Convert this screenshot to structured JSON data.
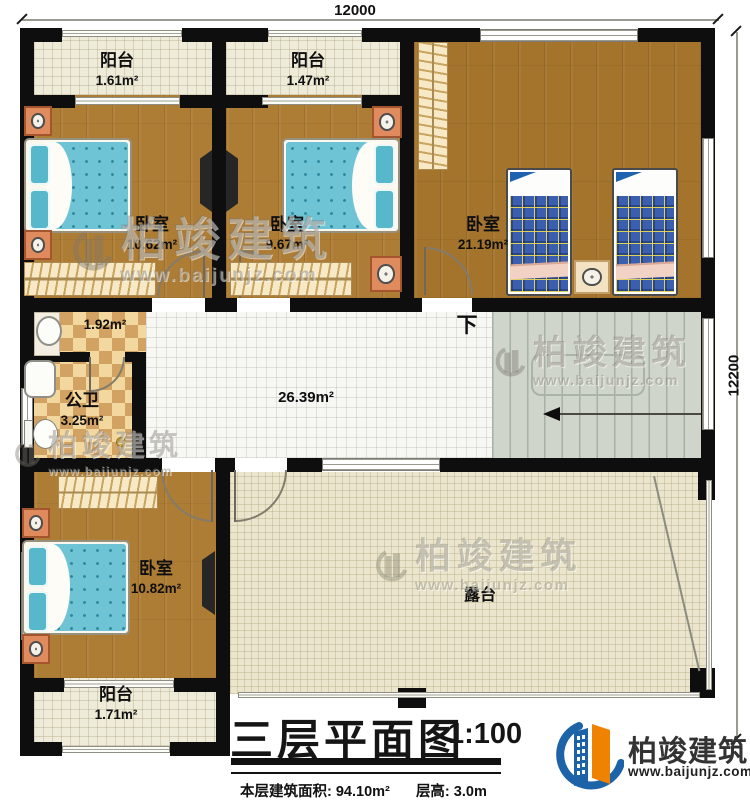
{
  "dimensions": {
    "width_label": "12000",
    "height_label": "12200"
  },
  "rooms": {
    "balcony_top_left": {
      "name": "阳台",
      "area": "1.61m²"
    },
    "balcony_top_mid": {
      "name": "阳台",
      "area": "1.47m²"
    },
    "bedroom_top_left": {
      "name": "卧室",
      "area": "10.62m²"
    },
    "bedroom_top_mid": {
      "name": "卧室",
      "area": "9.67m²"
    },
    "bedroom_top_right": {
      "name": "卧室",
      "area": "21.19m²"
    },
    "washbasin": {
      "area": "1.92m²"
    },
    "bathroom": {
      "name": "公卫",
      "area": "3.25m²"
    },
    "hallway": {
      "area": "26.39m²"
    },
    "bedroom_bottom": {
      "name": "卧室",
      "area": "10.82m²"
    },
    "balcony_bottom": {
      "name": "阳台",
      "area": "1.71m²"
    },
    "terrace": {
      "name": "露台"
    }
  },
  "stairs": {
    "direction_label": "下"
  },
  "title_block": {
    "title": "三层平面图",
    "scale": "1:100",
    "floor_area": "本层建筑面积: 94.10m²",
    "floor_height": "层高: 3.0m"
  },
  "brand": {
    "name": "柏竣建筑",
    "website": "www.baijunjz.com"
  },
  "watermark": {
    "name": "柏竣建筑",
    "website": "www.baijunjz.com"
  },
  "colors": {
    "wall": "#0e0e0e",
    "accent_blue": "#1c63a8",
    "accent_orange": "#ef8200"
  }
}
